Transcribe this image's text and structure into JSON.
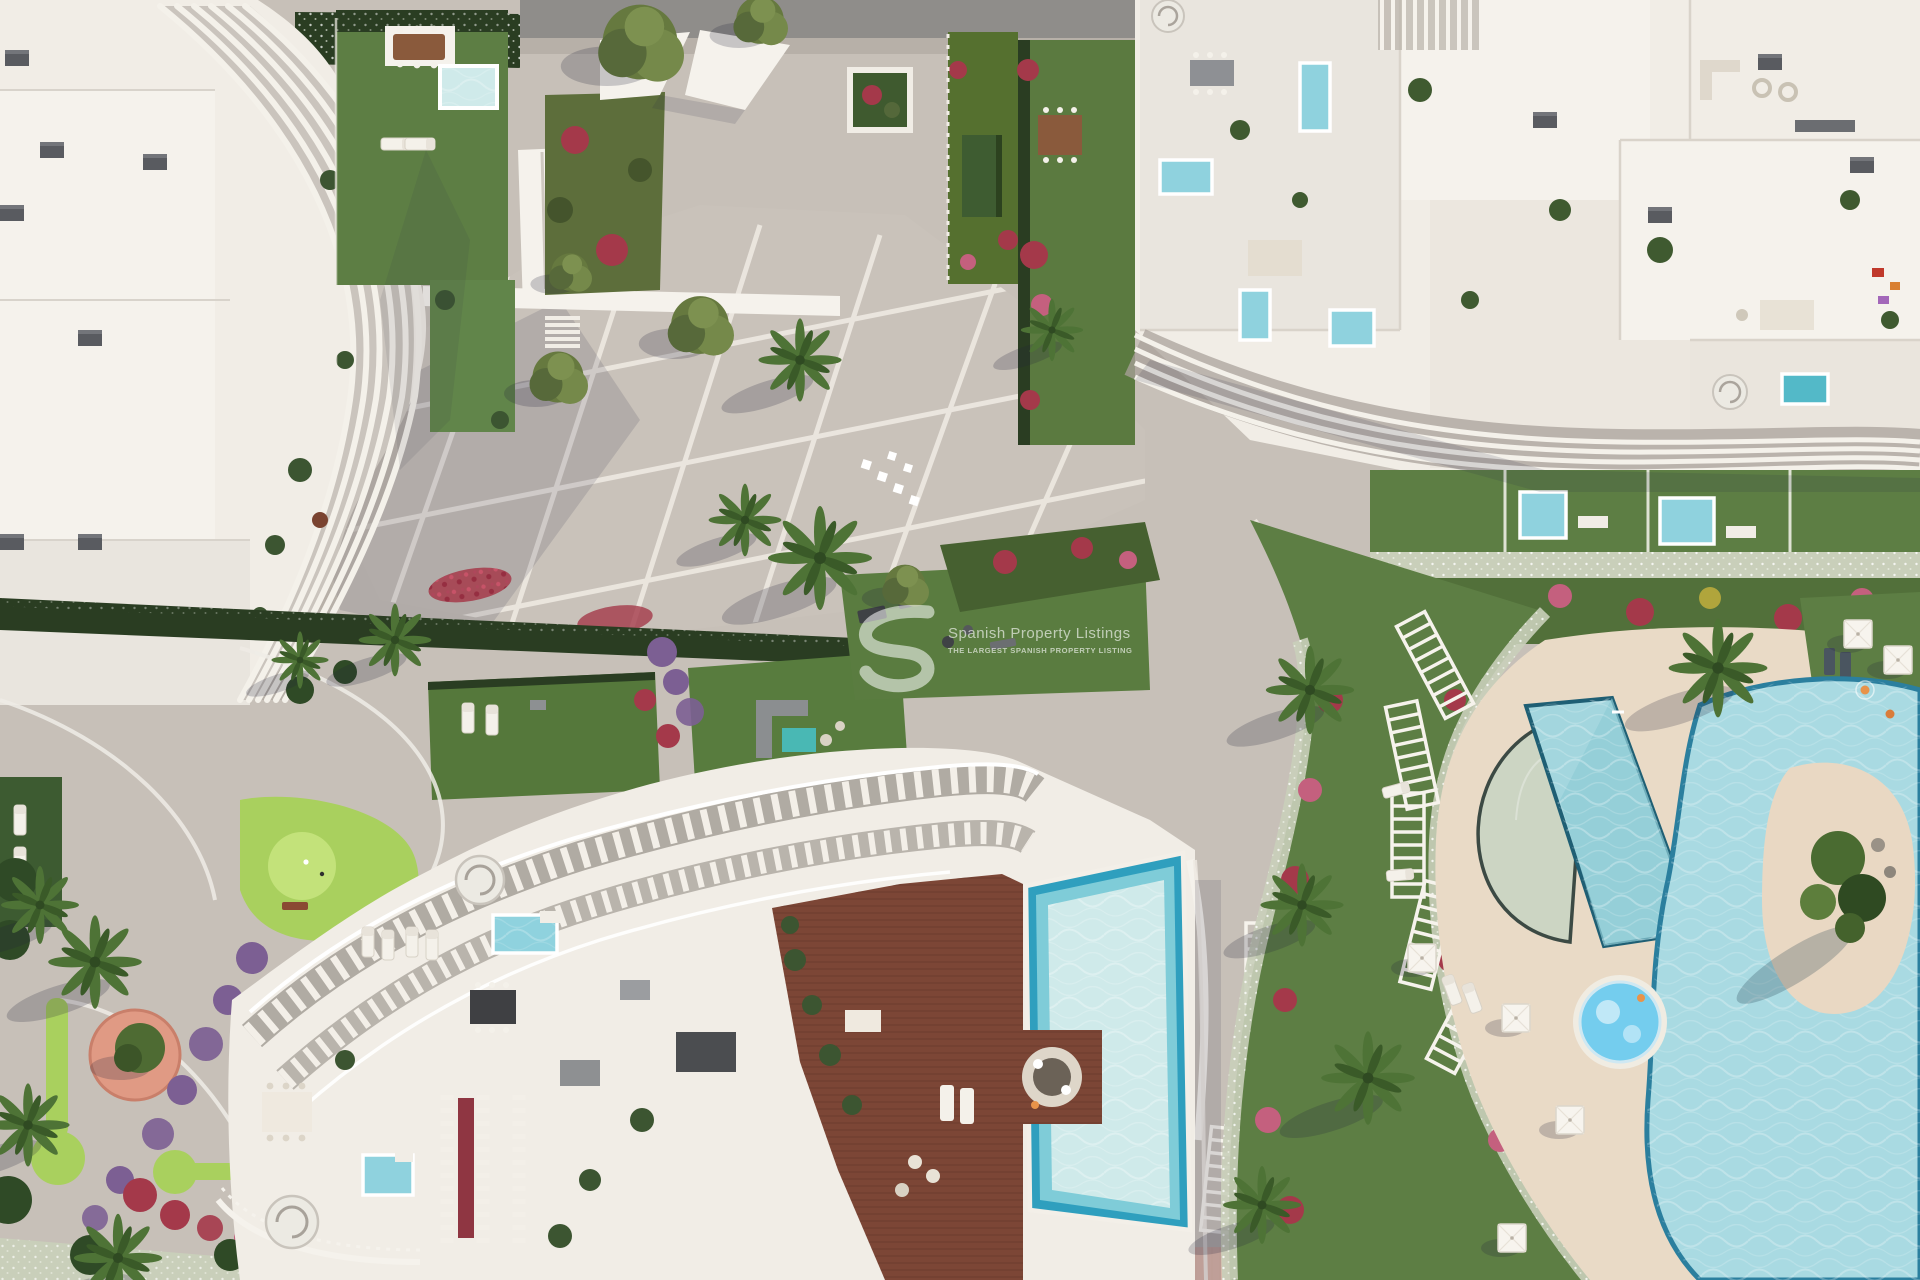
{
  "scene": {
    "type": "aerial-3d-architectural-render",
    "description": "Top-down aerial 3D rendering of a modern Mediterranean residential resort: curved white apartment buildings with wavy louvered rooftops and plunge pools, a paved central plaza, landscaped gardens with bougainvillea, a mini-golf lawn, a timber sun deck with a large pool, and a lagoon-style pool area with beach entry, island, spa and parasols",
    "watermark": {
      "logo_letter": "S",
      "line1": "Spanish Property Listings",
      "line2": "THE LARGEST SPANISH PROPERTY LISTING"
    },
    "palette": {
      "pavement": "#c7c0b8",
      "road": "#8f8d8a",
      "white": "#f1ede6",
      "panel": "#e9e5de",
      "panel2": "#f5f2ec",
      "louver": "#f4f1ea",
      "louverShadow": "#a9a29a",
      "lawn": "#5d7e44",
      "lawnDark": "#3d5931",
      "golf": "#a9d05e",
      "golfLight": "#c3e27a",
      "hedge": "#2a3d22",
      "hedgeWhite": "#c9cfba",
      "flowerRed": "#a4394a",
      "flowerPink": "#c4607e",
      "flowerPurple": "#7c5f93",
      "pool": "#8fd2de",
      "poolLight": "#cfeaea",
      "poolDeep": "#2f9fbe",
      "spa": "#74cdee",
      "sand": "#e9dac6",
      "wood": "#7c4636",
      "promenade": "#d8b3a6",
      "palm": "#4e7336",
      "treeOlive": "#66793f",
      "watermark": "#ffffff"
    },
    "features": [
      "louvered curved buildings",
      "rooftop plunge pools",
      "central plaza with pergola walkway",
      "mini golf greens",
      "lagoon pool with island",
      "round spa pool",
      "timber deck pool",
      "pergola rows",
      "palm trees",
      "bougainvillea beds",
      "beach promenade"
    ]
  }
}
